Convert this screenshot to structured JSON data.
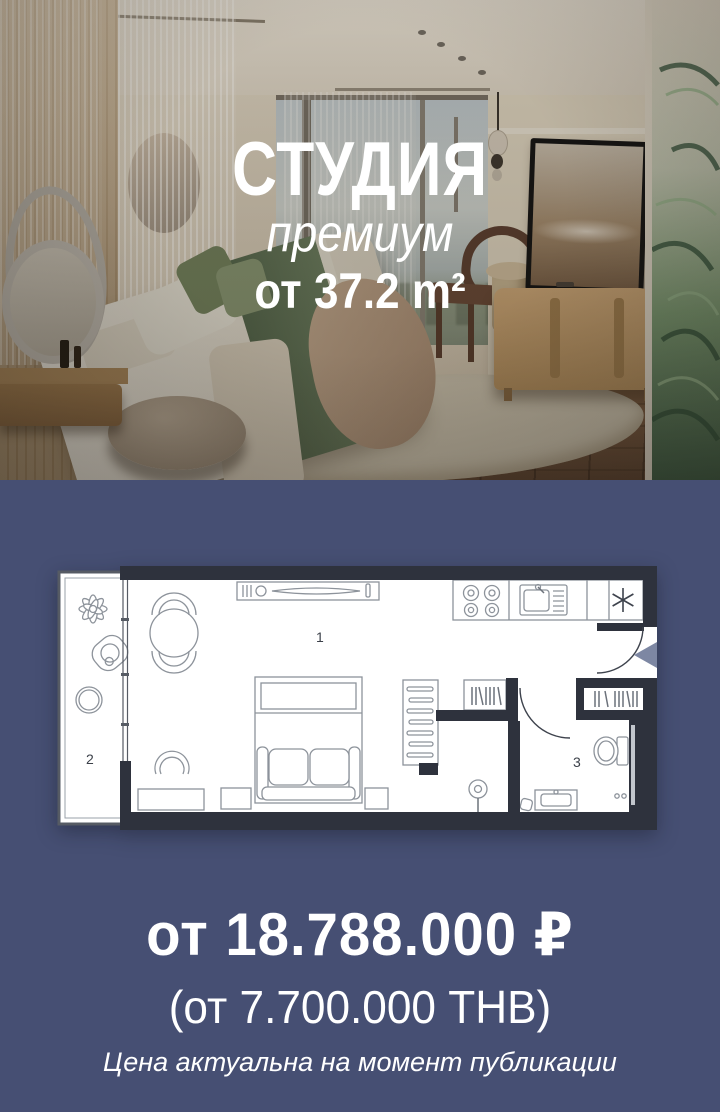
{
  "hero": {
    "title": "СТУДИЯ",
    "subtitle": "премиум",
    "area": "от 37.2 m²"
  },
  "floor_plan": {
    "room_labels": {
      "living": "1",
      "balcony": "2",
      "bathroom": "3"
    }
  },
  "pricing": {
    "price_rub": "от 18.788.000 ₽",
    "price_thb": "(от 7.700.000 THB)",
    "note": "Цена актуальна на момент публикации"
  },
  "colors": {
    "background": "#464f73",
    "plan_wall": "#2e323d",
    "plan_floor": "#ffffff",
    "furniture_line": "#8d939b",
    "entrance_arrow": "#7d87a3",
    "text": "#ffffff"
  }
}
